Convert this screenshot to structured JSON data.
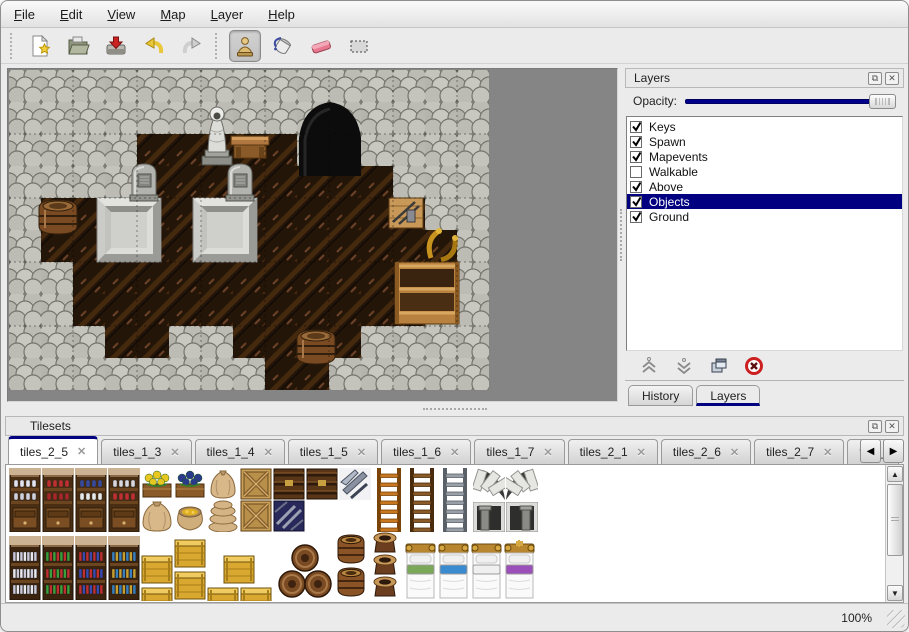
{
  "colors": {
    "accent": "#000080",
    "slider_blue": "#00008c",
    "map_bg": "#858585",
    "wall": "#b4b4ac",
    "floor": "#2a1a10"
  },
  "menu": {
    "items": [
      {
        "label": "File"
      },
      {
        "label": "Edit"
      },
      {
        "label": "View"
      },
      {
        "label": "Map"
      },
      {
        "label": "Layer"
      },
      {
        "label": "Help"
      }
    ]
  },
  "toolbar": {
    "items": [
      {
        "type": "grip"
      },
      {
        "type": "button",
        "icon": "new-file-icon",
        "selected": false
      },
      {
        "type": "button",
        "icon": "open-folder-icon",
        "selected": false
      },
      {
        "type": "button",
        "icon": "save-icon",
        "selected": false
      },
      {
        "type": "button",
        "icon": "undo-icon",
        "selected": false
      },
      {
        "type": "button",
        "icon": "redo-icon",
        "selected": false
      },
      {
        "type": "grip"
      },
      {
        "type": "button",
        "icon": "stamp-tool-icon",
        "selected": true
      },
      {
        "type": "button",
        "icon": "fill-tool-icon",
        "selected": false
      },
      {
        "type": "button",
        "icon": "eraser-tool-icon",
        "selected": false
      },
      {
        "type": "button",
        "icon": "select-tool-icon",
        "selected": false
      }
    ]
  },
  "layers_panel": {
    "title": "Layers",
    "float_icon": "float-icon",
    "close_icon": "close-icon",
    "opacity_label": "Opacity:",
    "layers": [
      {
        "name": "Keys",
        "checked": true,
        "selected": false
      },
      {
        "name": "Spawn",
        "checked": true,
        "selected": false
      },
      {
        "name": "Mapevents",
        "checked": true,
        "selected": false
      },
      {
        "name": "Walkable",
        "checked": false,
        "selected": false
      },
      {
        "name": "Above",
        "checked": true,
        "selected": false
      },
      {
        "name": "Objects",
        "checked": true,
        "selected": true
      },
      {
        "name": "Ground",
        "checked": true,
        "selected": false
      }
    ],
    "action_icons": [
      "move-up-icon",
      "move-down-icon",
      "duplicate-icon",
      "delete-icon"
    ],
    "tabs": [
      {
        "label": "History",
        "active": false
      },
      {
        "label": "Layers",
        "active": true
      }
    ]
  },
  "tilesets_panel": {
    "title": "Tilesets",
    "tabs": [
      {
        "label": "tiles_2_5",
        "active": true
      },
      {
        "label": "tiles_1_3",
        "active": false
      },
      {
        "label": "tiles_1_4",
        "active": false
      },
      {
        "label": "tiles_1_5",
        "active": false
      },
      {
        "label": "tiles_1_6",
        "active": false
      },
      {
        "label": "tiles_1_7",
        "active": false
      },
      {
        "label": "tiles_2_1",
        "active": false
      },
      {
        "label": "tiles_2_6",
        "active": false
      },
      {
        "label": "tiles_2_7",
        "active": false
      },
      {
        "label": "tiles_",
        "active": false,
        "partial": true
      }
    ],
    "scroll_left": "scroll-left-icon",
    "scroll_right": "scroll-right-icon"
  },
  "status": {
    "zoom": "100%"
  },
  "map": {
    "tile_size": 32,
    "grid": [
      "WWWWWWWWWWWWWWW",
      "WWWWWWWWWWWWWWW",
      "WWWWFFFFFWWWWWW",
      "WWWWFFFFFFFFWWW",
      "WFFFFFFFFFFFFWW",
      "WFFFFFFFFFFFFFW",
      "WWFFFFFFFFFFFFW",
      "WWFFFFFFFFFFFWW",
      "WWWFFWWFFFFWWWW",
      "WWWWWWWWFFWWWWW"
    ],
    "objects": [
      {
        "type": "cave",
        "x": 288,
        "y": 30
      },
      {
        "type": "slab",
        "x": 88,
        "y": 128
      },
      {
        "type": "slab",
        "x": 184,
        "y": 128
      },
      {
        "type": "tombstone",
        "x": 120,
        "y": 92
      },
      {
        "type": "tombstone",
        "x": 216,
        "y": 92
      },
      {
        "type": "statue",
        "x": 190,
        "y": 34
      },
      {
        "type": "table",
        "x": 222,
        "y": 62
      },
      {
        "type": "toolcrate",
        "x": 380,
        "y": 124
      },
      {
        "type": "horn",
        "x": 414,
        "y": 156
      },
      {
        "type": "cabinet",
        "x": 386,
        "y": 192
      },
      {
        "type": "barrel",
        "x": 28,
        "y": 126
      },
      {
        "type": "barrel",
        "x": 286,
        "y": 256
      }
    ]
  },
  "tileset_tiles": [
    {
      "t": "shopshelf",
      "x": 2,
      "y": 2,
      "v": 0
    },
    {
      "t": "shopshelf",
      "x": 35,
      "y": 2,
      "v": 1
    },
    {
      "t": "shopshelf",
      "x": 68,
      "y": 2,
      "v": 2
    },
    {
      "t": "shopshelf",
      "x": 101,
      "y": 2,
      "v": 3
    },
    {
      "t": "flower",
      "x": 134,
      "y": 2,
      "v": 0
    },
    {
      "t": "flower",
      "x": 167,
      "y": 2,
      "v": 1
    },
    {
      "t": "sack",
      "x": 200,
      "y": 2
    },
    {
      "t": "cratex",
      "x": 233,
      "y": 2
    },
    {
      "t": "cratedark",
      "x": 266,
      "y": 2
    },
    {
      "t": "cratedark",
      "x": 299,
      "y": 2
    },
    {
      "t": "metal",
      "x": 332,
      "y": 2
    },
    {
      "t": "ladder",
      "x": 366,
      "y": 2,
      "v": 0
    },
    {
      "t": "ladder",
      "x": 399,
      "y": 2,
      "v": 1
    },
    {
      "t": "ladder",
      "x": 432,
      "y": 2,
      "v": 2
    },
    {
      "t": "arch",
      "x": 466,
      "y": 2,
      "v": 0
    },
    {
      "t": "arch",
      "x": 499,
      "y": 2,
      "v": 1
    },
    {
      "t": "sackbig",
      "x": 134,
      "y": 34
    },
    {
      "t": "sackopen",
      "x": 167,
      "y": 34
    },
    {
      "t": "sackpile",
      "x": 200,
      "y": 34
    },
    {
      "t": "cratex",
      "x": 233,
      "y": 34
    },
    {
      "t": "cratenavy",
      "x": 266,
      "y": 34
    },
    {
      "t": "stonedoor",
      "x": 466,
      "y": 36,
      "v": 0
    },
    {
      "t": "stonedoor",
      "x": 499,
      "y": 36,
      "v": 1
    },
    {
      "t": "bookshelf",
      "x": 2,
      "y": 70,
      "v": 0
    },
    {
      "t": "bookshelf",
      "x": 35,
      "y": 70,
      "v": 1
    },
    {
      "t": "bookshelf",
      "x": 68,
      "y": 70,
      "v": 2
    },
    {
      "t": "bookshelf",
      "x": 101,
      "y": 70,
      "v": 3
    },
    {
      "t": "cratey",
      "x": 134,
      "y": 86
    },
    {
      "t": "cratey",
      "x": 134,
      "y": 118
    },
    {
      "t": "cratey",
      "x": 167,
      "y": 70
    },
    {
      "t": "cratey",
      "x": 167,
      "y": 102
    },
    {
      "t": "cratey",
      "x": 216,
      "y": 86
    },
    {
      "t": "cratey",
      "x": 200,
      "y": 118
    },
    {
      "t": "cratey",
      "x": 233,
      "y": 118
    },
    {
      "t": "barrelpile",
      "x": 270,
      "y": 76
    },
    {
      "t": "barrel",
      "x": 329,
      "y": 66
    },
    {
      "t": "barrel",
      "x": 329,
      "y": 99
    },
    {
      "t": "potstack",
      "x": 362,
      "y": 64
    },
    {
      "t": "bed",
      "x": 398,
      "y": 70,
      "v": 0
    },
    {
      "t": "bed",
      "x": 431,
      "y": 70,
      "v": 1
    },
    {
      "t": "bed",
      "x": 464,
      "y": 70,
      "v": 2
    },
    {
      "t": "bed",
      "x": 497,
      "y": 70,
      "v": 3
    }
  ]
}
